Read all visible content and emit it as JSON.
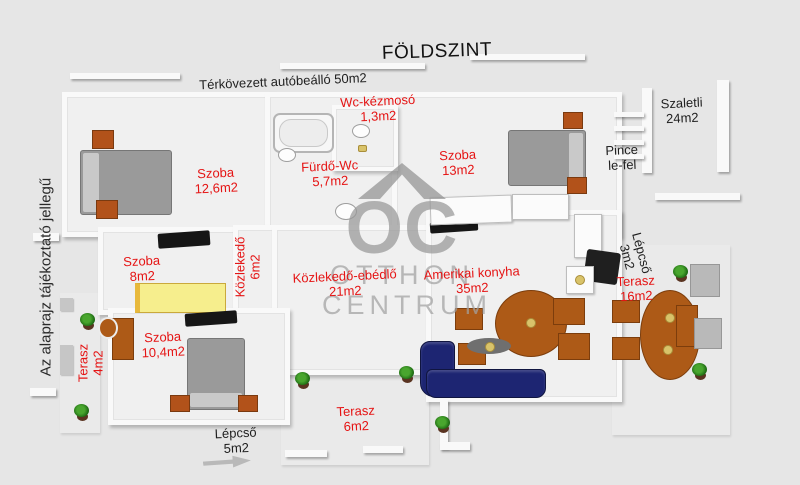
{
  "title": "FÖLDSZINT",
  "disclaimer": "Az alaprajz tájékoztató jellegű",
  "watermark": {
    "monogram": "OC",
    "word1": "OTTHON",
    "word2": "CENTRUM"
  },
  "colors": {
    "background": "#e6e6e6",
    "room_label_red": "#e51414",
    "text_black": "#1f1f1f",
    "wood_brown": "#ad5a17",
    "sofa_navy": "#1d2572",
    "bed_gray": "#9a9a9a",
    "bed_yellow": "#f6ee8d",
    "watermark_gray": "#9a9a9a"
  },
  "rooms": {
    "carport": {
      "label": "Térkövezett autóbeálló 50m2"
    },
    "wc": {
      "name": "Wc-kézmosó",
      "area": "1,3m2"
    },
    "bathroom": {
      "name": "Fürdő-Wc",
      "area": "5,7m2"
    },
    "bedroom1": {
      "name": "Szoba",
      "area": "12,6m2"
    },
    "bedroom2": {
      "name": "Szoba",
      "area": "13m2"
    },
    "bedroom3": {
      "name": "Szoba",
      "area": "8m2"
    },
    "bedroom4": {
      "name": "Szoba",
      "area": "10,4m2"
    },
    "hallway": {
      "name": "Közlekedő",
      "area": "6m2"
    },
    "dining": {
      "name": "Közlekedő-ebédlő",
      "area": "21m2"
    },
    "kitchen": {
      "name": "Amerikai konyha",
      "area": "35m2"
    },
    "szaletli": {
      "name": "Szaletli",
      "area": "24m2"
    },
    "cellar": {
      "line1": "Pince",
      "line2": "le-fel"
    },
    "stairs_small": {
      "name": "Lépcső",
      "area": "3m2"
    },
    "stairs_main": {
      "name": "Lépcső",
      "area": "5m2"
    },
    "terrace_left": {
      "name": "Terasz",
      "area": "4m2"
    },
    "terrace_bottom": {
      "name": "Terasz",
      "area": "6m2"
    },
    "terrace_right": {
      "name": "Terasz",
      "area": "16m2"
    }
  }
}
